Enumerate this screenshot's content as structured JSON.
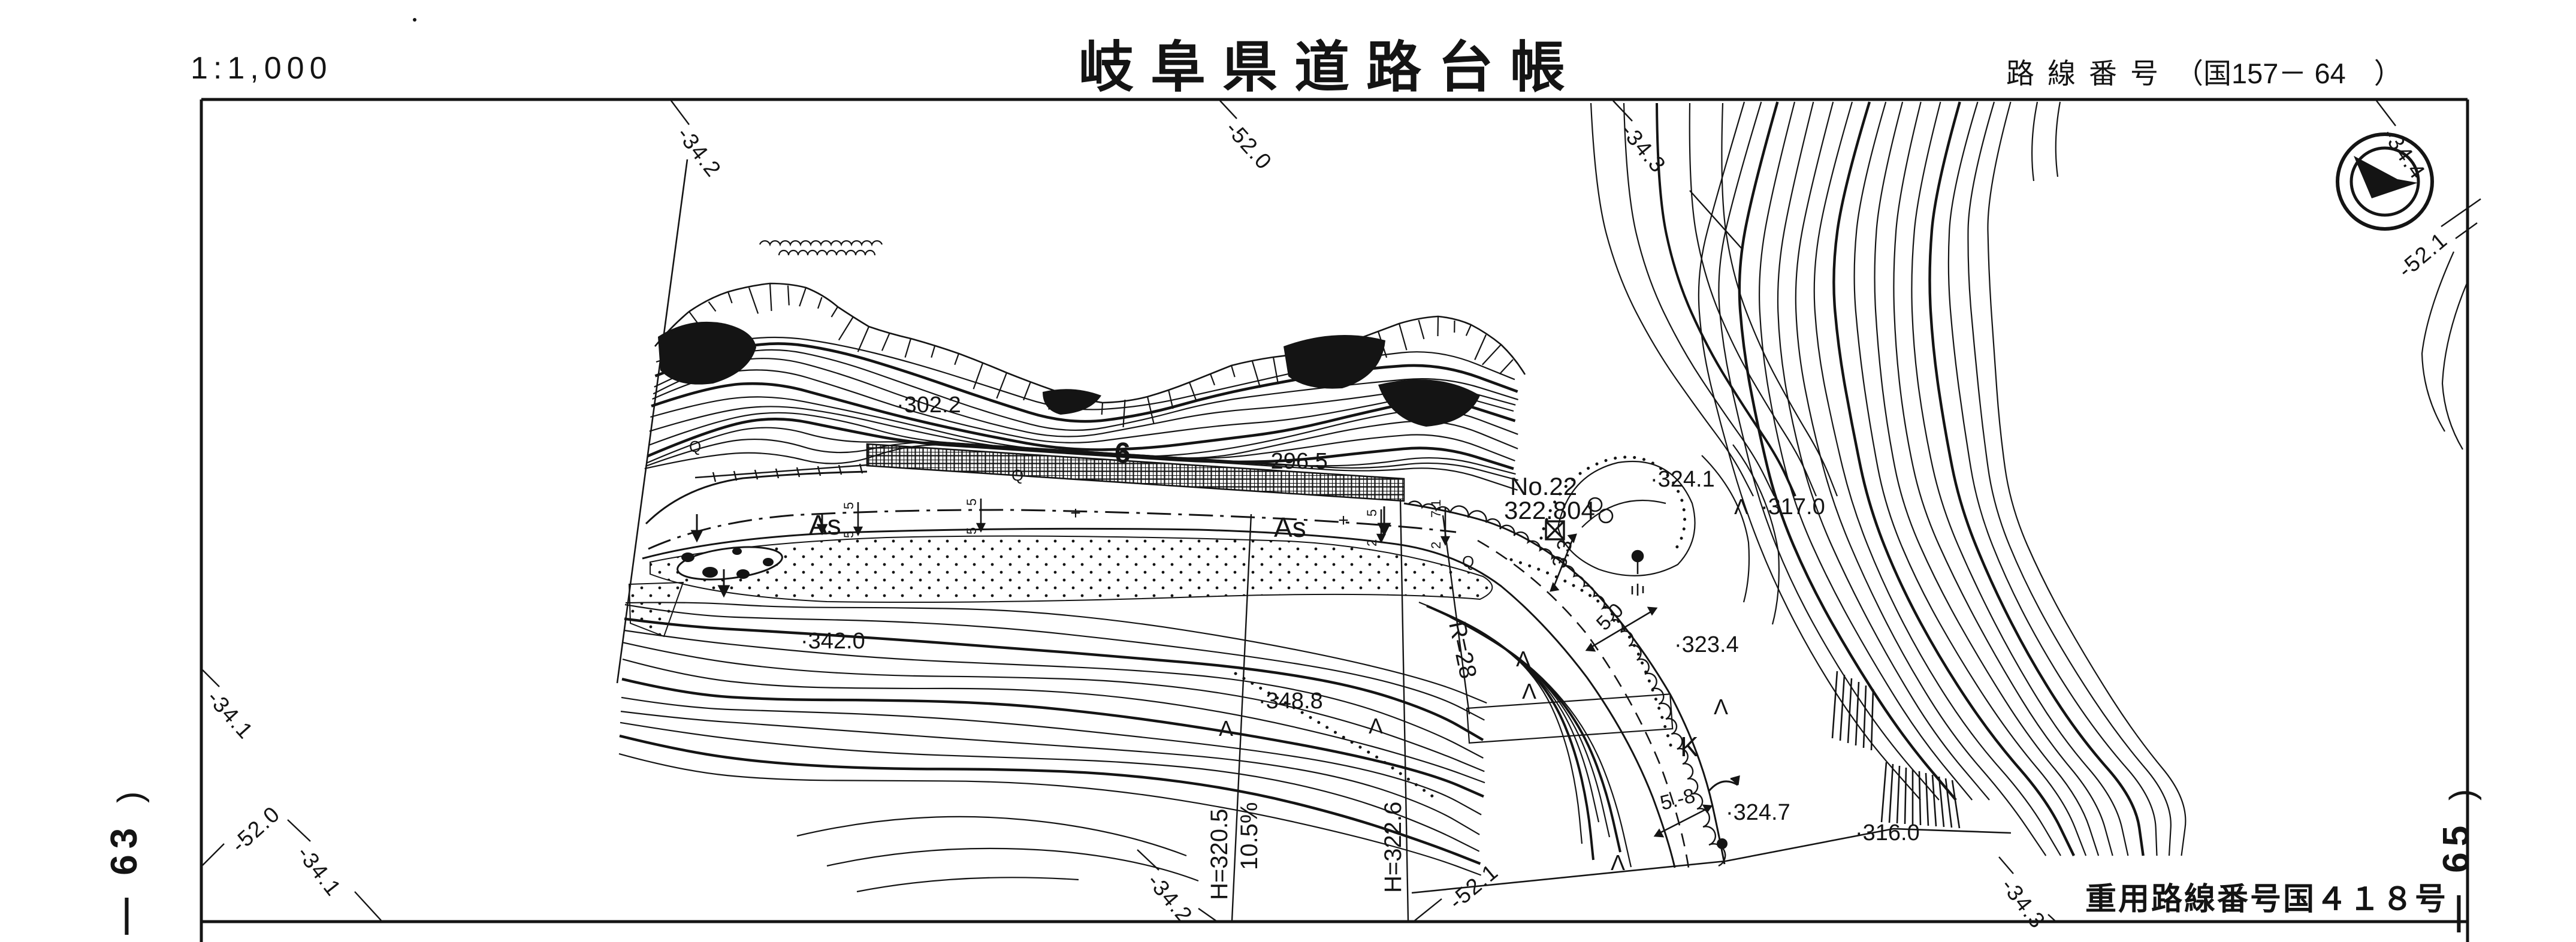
{
  "header": {
    "scale": "1:1,000",
    "title": "岐阜県道路台帳",
    "route_caption": "路線番号",
    "route_number": "（国157－ 64　）"
  },
  "footer": {
    "joint_route": "重用路線番号国４１８号"
  },
  "sheet_refs": {
    "left_paren": ")",
    "left_number": "— 63",
    "right_paren": ")",
    "right_number": "— 65"
  },
  "grid_labels": {
    "tl": "-34.2",
    "tc": "-52.0",
    "tcr": "-34.3",
    "tr": "-34.4",
    "r": "-52.1",
    "l1": "-34.1",
    "l2": "-52.0",
    "l3": "-34.1",
    "b1": "-34.2",
    "b2": "-52.1",
    "b3": "-34.3"
  },
  "map": {
    "surface1": "As",
    "surface2": "As",
    "wall_no": "6",
    "station": {
      "no": "No.22",
      "elev": "322.804"
    },
    "spots": {
      "e302": "·302.2",
      "e296": "·296.5",
      "e342": "·342.0",
      "e348": "·348.8",
      "e3241": "·324.1",
      "e317": "·317.0",
      "e323": "·323.4",
      "e3247": "·324.7",
      "e316": "·316.0"
    },
    "dims": {
      "d33": "3.3",
      "d50": "5.0",
      "d58": "5.-8"
    },
    "curve_radius": "R=28",
    "profile": {
      "h1": "H=320.5",
      "g1": "10.5%",
      "h2": "H=322.6"
    },
    "k_label": "K",
    "ticks": [
      "5",
      "5",
      "5",
      "5",
      "5",
      "2",
      "7.1",
      "2"
    ],
    "symbols": {
      "q": "Q",
      "tree": "Λ",
      "plus": "+"
    }
  }
}
